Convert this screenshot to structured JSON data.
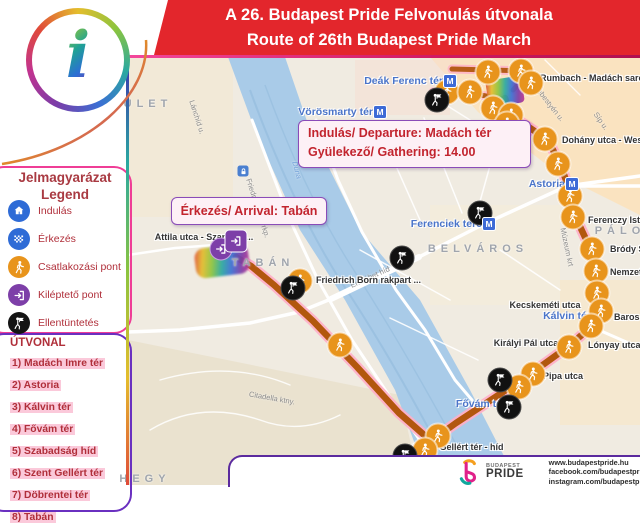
{
  "header": {
    "title_hu": "A 26. Budapest Pride Felvonulás útvonala",
    "title_en": "Route of 26th Budapest Pride March",
    "bg_color": "#e3262c"
  },
  "info_logo": {
    "letter": "i"
  },
  "legend": {
    "title_line1": "Jelmagyarázat",
    "title_line2": "Legend",
    "items": [
      {
        "icon": "start-house-icon",
        "color": "#2e6bd6",
        "label": "Indulás"
      },
      {
        "icon": "finish-flag-icon",
        "color": "#2e6bd6",
        "label": "Érkezés"
      },
      {
        "icon": "join-walker-icon",
        "color": "#e8941c",
        "label": "Csatlakozási pont"
      },
      {
        "icon": "exit-door-icon",
        "color": "#7d3fa8",
        "label": "Kiléptető pont"
      },
      {
        "icon": "counter-protest-icon",
        "color": "#141414",
        "label": "Ellentüntetés"
      }
    ]
  },
  "route_list": {
    "title": "ÚTVONAL",
    "items": [
      "1) Madách Imre tér",
      "2) Astoria",
      "3) Kálvin tér",
      "4) Fővám tér",
      "5) Szabadság híd",
      "6) Szent Gellért tér",
      "7) Döbrentei tér",
      "8) Tabán"
    ]
  },
  "callouts": {
    "departure": {
      "line1": "Indulás/ Departure: Madách tér",
      "line2": "Gyülekező/ Gathering: 14.00"
    },
    "arrival": {
      "line1": "Érkezés/ Arrival:  Tabán"
    }
  },
  "footer": {
    "brand_name_top": "BUDAPEST",
    "brand_name_bottom": "PRIDE",
    "links": [
      "www.budapestpride.hu",
      "facebook.com/budapestpride",
      "instagram.com/budapestpride"
    ]
  },
  "map": {
    "route_color": "#b2570e",
    "route_halo_color": "#ffaec6",
    "join_marker_color": "#e8941c",
    "counter_marker_color": "#111111",
    "exit_marker_color": "#7d3fa8",
    "metro_color": "#3d6ad6",
    "water_color": "#a9cbe8",
    "route": {
      "main": [
        [
          505,
          98
        ],
        [
          512,
          116
        ],
        [
          548,
          140
        ],
        [
          561,
          166
        ],
        [
          568,
          186
        ],
        [
          576,
          218
        ],
        [
          591,
          250
        ],
        [
          597,
          272
        ],
        [
          599,
          294
        ],
        [
          601,
          311
        ],
        [
          592,
          326
        ],
        [
          569,
          346
        ],
        [
          533,
          372
        ],
        [
          497,
          396
        ],
        [
          456,
          423
        ],
        [
          431,
          441
        ],
        [
          399,
          413
        ],
        [
          357,
          367
        ],
        [
          313,
          321
        ],
        [
          274,
          285
        ],
        [
          251,
          266
        ],
        [
          236,
          257
        ]
      ],
      "branches": [
        [
          [
            452,
            69
          ],
          [
            530,
            71
          ],
          [
            513,
            90
          ]
        ],
        [
          [
            433,
            92
          ],
          [
            470,
            93
          ],
          [
            502,
            99
          ]
        ]
      ]
    },
    "join_markers": [
      [
        447,
        92
      ],
      [
        470,
        92
      ],
      [
        488,
        72
      ],
      [
        521,
        71
      ],
      [
        531,
        83
      ],
      [
        493,
        108
      ],
      [
        511,
        115
      ],
      [
        507,
        124
      ],
      [
        545,
        139
      ],
      [
        558,
        164
      ],
      [
        570,
        196
      ],
      [
        573,
        217
      ],
      [
        592,
        249
      ],
      [
        596,
        271
      ],
      [
        597,
        293
      ],
      [
        601,
        311
      ],
      [
        591,
        326
      ],
      [
        569,
        347
      ],
      [
        533,
        374
      ],
      [
        519,
        387
      ],
      [
        438,
        436
      ],
      [
        425,
        450
      ],
      [
        300,
        281
      ],
      [
        340,
        345
      ]
    ],
    "counter_markers": [
      [
        437,
        100
      ],
      [
        480,
        213
      ],
      [
        402,
        258
      ],
      [
        293,
        288
      ],
      [
        500,
        380
      ],
      [
        509,
        407
      ],
      [
        405,
        456
      ]
    ],
    "metro_markers": [
      [
        450,
        81
      ],
      [
        380,
        112
      ],
      [
        572,
        184
      ],
      [
        489,
        224
      ]
    ],
    "lock_marker": [
      243,
      171
    ],
    "exit_marker": {
      "circle": [
        221,
        249
      ],
      "square": [
        236,
        241
      ]
    },
    "station_labels": [
      {
        "t": "Deák Ferenc tér",
        "x": 443,
        "y": 81,
        "a": "r"
      },
      {
        "t": "Vörösmarty tér",
        "x": 373,
        "y": 112,
        "a": "r"
      },
      {
        "t": "Astoria",
        "x": 565,
        "y": 184,
        "a": "r"
      },
      {
        "t": "Ferenciek tere",
        "x": 482,
        "y": 224,
        "a": "r"
      },
      {
        "t": "Kálvin tér",
        "x": 567,
        "y": 316,
        "a": "c"
      },
      {
        "t": "Fővám tér",
        "x": 481,
        "y": 404,
        "a": "c"
      }
    ],
    "poi_labels": [
      {
        "t": "Rumbach - Madách sarok",
        "x": 540,
        "y": 78,
        "a": "l"
      },
      {
        "t": "Dohány utca - Wess",
        "x": 562,
        "y": 140,
        "a": "l"
      },
      {
        "t": "Ferenczy Istv",
        "x": 588,
        "y": 220,
        "a": "l"
      },
      {
        "t": "Bródy Sá",
        "x": 610,
        "y": 249,
        "a": "l"
      },
      {
        "t": "Nemzet",
        "x": 610,
        "y": 272,
        "a": "l"
      },
      {
        "t": "Kecskeméti utca",
        "x": 545,
        "y": 305,
        "a": "c"
      },
      {
        "t": "Baros",
        "x": 614,
        "y": 317,
        "a": "l"
      },
      {
        "t": "Királyi Pál utca",
        "x": 526,
        "y": 343,
        "a": "c"
      },
      {
        "t": "Lónyay utca",
        "x": 588,
        "y": 345,
        "a": "l"
      },
      {
        "t": "Pipa utca",
        "x": 563,
        "y": 376,
        "a": "c"
      },
      {
        "t": "Friedrich Born rakpart ...",
        "x": 316,
        "y": 280,
        "a": "l"
      },
      {
        "t": "Attila utca - Szarvas t...",
        "x": 204,
        "y": 237,
        "a": "c"
      },
      {
        "t": "Szent Gellért tér - híd",
        "x": 413,
        "y": 447,
        "a": "l"
      }
    ],
    "area_labels": [
      {
        "t": "BELVÁROS",
        "x": 478,
        "y": 249
      },
      {
        "t": "TABÁN",
        "x": 263,
        "y": 263
      },
      {
        "t": "ULET",
        "x": 148,
        "y": 104
      },
      {
        "t": "HEGY",
        "x": 145,
        "y": 479
      },
      {
        "t": "PÁLO",
        "x": 620,
        "y": 231
      }
    ],
    "street_labels": [
      {
        "t": "Lánchíd u.",
        "x": 197,
        "y": 117,
        "r": 72
      },
      {
        "t": "Friedrich Born rkp.",
        "x": 258,
        "y": 208,
        "r": 72
      },
      {
        "t": "Duna",
        "x": 297,
        "y": 170,
        "r": 75,
        "w": 1
      },
      {
        "t": "Erzsébet híd",
        "x": 370,
        "y": 277,
        "r": -24
      },
      {
        "t": "Sebestyén u.",
        "x": 549,
        "y": 103,
        "r": 52
      },
      {
        "t": "Síp u.",
        "x": 601,
        "y": 121,
        "r": 55
      },
      {
        "t": "Múzeum krt",
        "x": 567,
        "y": 247,
        "r": 78
      },
      {
        "t": "Citadella ktny.",
        "x": 272,
        "y": 398,
        "r": 10
      }
    ]
  }
}
